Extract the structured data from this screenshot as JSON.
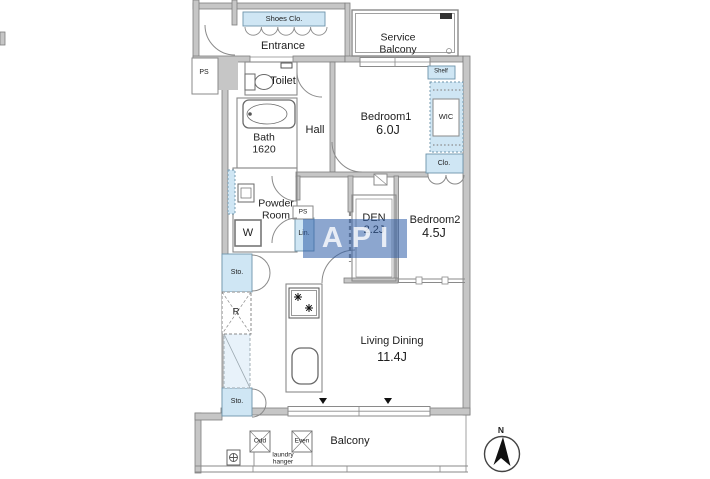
{
  "plan": {
    "watermark": "API",
    "compass": "N",
    "colors": {
      "fixture_blue": "#cfe6f4",
      "wall_gray": "#c6c6c6",
      "line_gray": "#8a8a8a",
      "watermark_blue": "#2d5da8"
    },
    "labels": {
      "shoes_closet": "Shoes Clo.",
      "entrance": "Entrance",
      "service_balcony": "Service\nBalcony",
      "ps_shaft": "PS",
      "toilet": "Toilet",
      "bath": "Bath\n1620",
      "hall": "Hall",
      "bedroom1": "Bedroom1",
      "bedroom1_area": "6.0J",
      "shelf": "Shelf",
      "wic": "WIC",
      "closet": "Clo.",
      "powder_room": "Powder\nRoom",
      "ps_duct": "PS",
      "linen": "Lin.",
      "den": "DEN",
      "den_area": "2.2J",
      "bedroom2": "Bedroom2",
      "bedroom2_area": "4.5J",
      "washer": "W",
      "storage_upper": "Sto.",
      "refrigerator": "R",
      "storage_lower": "Sto.",
      "living_dining": "Living Dining",
      "living_dining_area": "11.4J",
      "balcony": "Balcony",
      "hanger_odd": "Odd",
      "hanger_even": "Even",
      "laundry_hanger": "laundry\nhanger"
    }
  }
}
